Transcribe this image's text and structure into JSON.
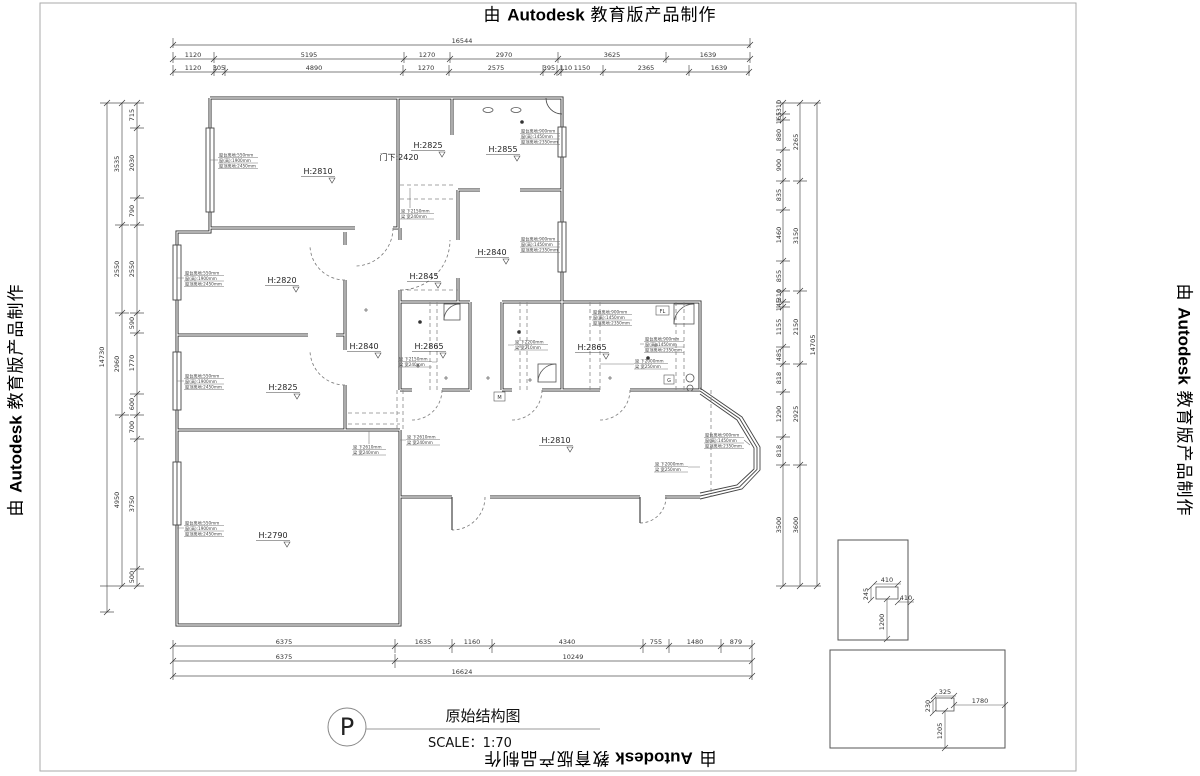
{
  "banners": {
    "pre": "由 ",
    "brand": "Autodesk",
    "post": " 教育版产品制作"
  },
  "title_block": {
    "symbol": "P",
    "title": "原始结构图",
    "scale": "SCALE：1:70"
  },
  "door_label": "门下:2420",
  "rooms": [
    {
      "label": "H:2810"
    },
    {
      "label": "H:2825"
    },
    {
      "label": "H:2855"
    },
    {
      "label": "H:2840"
    },
    {
      "label": "H:2820"
    },
    {
      "label": "H:2845"
    },
    {
      "label": "H:2840"
    },
    {
      "label": "H:2865"
    },
    {
      "label": "H:2865"
    },
    {
      "label": "H:2825"
    },
    {
      "label": "H:2810"
    },
    {
      "label": "H:2790"
    }
  ],
  "dims": {
    "top": {
      "total": "16544",
      "row1": [
        "1120",
        "5195",
        "1270",
        "2970",
        "3625",
        "1639"
      ],
      "row2": [
        "1120",
        "305",
        "4890",
        "1270",
        "2575",
        "395",
        "110",
        "1150",
        "2365",
        "1639"
      ]
    },
    "bottom": {
      "row1": [
        "6375",
        "1635",
        "1160",
        "4340",
        "755",
        "1480",
        "879"
      ],
      "row2": [
        "6375",
        "10249"
      ],
      "total": "16624"
    },
    "left": {
      "outer": "14730",
      "mid": [
        "3535",
        "2550",
        "2960",
        "4950"
      ],
      "inner": [
        "715",
        "2030",
        "790",
        "2550",
        "590",
        "1770",
        "600",
        "700",
        "3750",
        "500"
      ]
    },
    "right": {
      "outer": "14705",
      "mid": [
        "2265",
        "3150",
        "2150",
        "2925",
        "3600"
      ],
      "inner": [
        "310",
        "165",
        "880",
        "900",
        "835",
        "1460",
        "855",
        "310",
        "145",
        "1155",
        "485",
        "818",
        "1290",
        "818",
        "3500"
      ]
    },
    "detail_a": [
      "410",
      "245",
      "410",
      "1200"
    ],
    "detail_b": [
      "325",
      "230",
      "1780",
      "1205"
    ]
  },
  "annotations": [
    {
      "lines": [
        "窗台离地:550mm",
        "窗(高):1900mm",
        "窗顶离地:2450mm"
      ]
    },
    {
      "lines": [
        "窗台离地:550mm",
        "窗(高):1900mm",
        "窗顶离地:2450mm"
      ]
    },
    {
      "lines": [
        "窗台离地:550mm",
        "窗(高):1900mm",
        "窗顶离地:2450mm"
      ]
    },
    {
      "lines": [
        "窗台离地:550mm",
        "窗(高):1900mm",
        "窗顶离地:2450mm"
      ]
    },
    {
      "lines": [
        "窗台离地:900mm",
        "窗(高):1450mm",
        "窗顶离地:2350mm"
      ]
    },
    {
      "lines": [
        "窗台离地:900mm",
        "窗(高):1450mm",
        "窗顶离地:2350mm"
      ]
    },
    {
      "lines": [
        "窗台离地:900mm",
        "窗(高):1450mm",
        "窗顶离地:2350mm"
      ]
    },
    {
      "lines": [
        "窗台离地:900mm",
        "窗(高):1450mm",
        "窗顶离地:2350mm"
      ]
    },
    {
      "lines": [
        "梁 下2150mm",
        "梁 宽240mm"
      ]
    },
    {
      "lines": [
        "梁 下2610mm",
        "梁 宽240mm"
      ]
    },
    {
      "lines": [
        "梁 下2610mm",
        "梁 宽240mm"
      ]
    },
    {
      "lines": [
        "梁 下2150mm",
        "梁 宽240mm"
      ]
    },
    {
      "lines": [
        "梁 下2200mm",
        "梁 宽210mm"
      ]
    },
    {
      "lines": [
        "梁 下2000mm",
        "梁 宽250mm"
      ]
    },
    {
      "lines": [
        "窗台离地:900mm",
        "窗(高):1450mm",
        "窗顶离地:2350mm"
      ]
    },
    {
      "lines": [
        "梁 下2000mm",
        "梁 宽250mm"
      ]
    }
  ],
  "equipment": [
    {
      "label": "FL"
    },
    {
      "label": "G"
    },
    {
      "label": "M"
    }
  ]
}
